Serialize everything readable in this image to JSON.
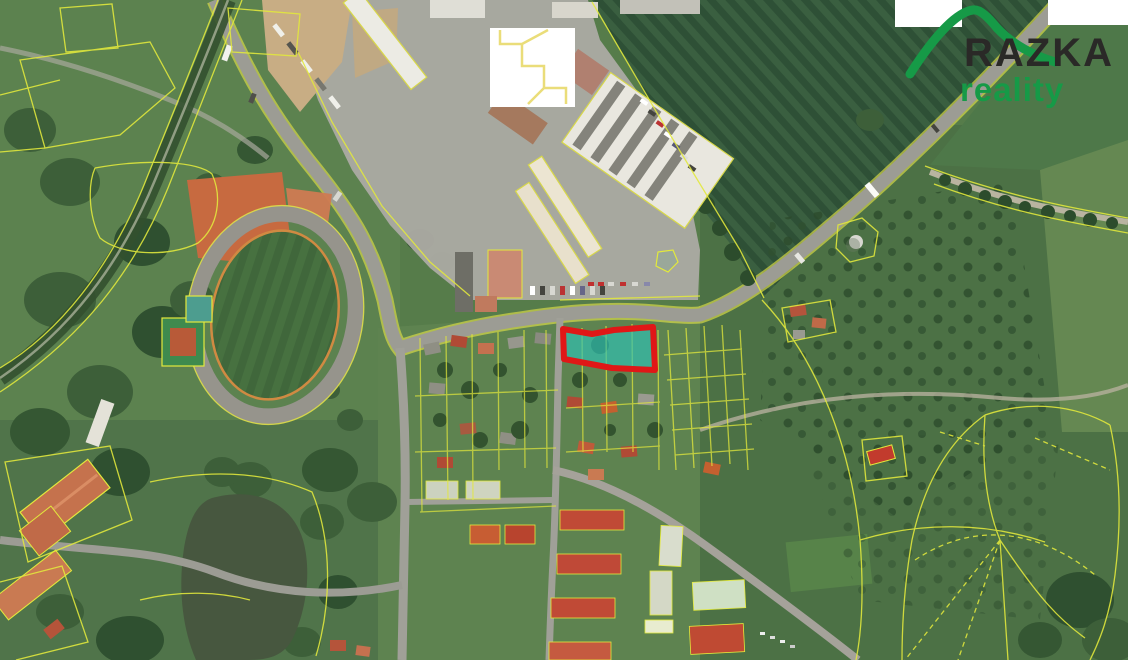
{
  "page": {
    "type": "aerial-cadastral-map-screenshot",
    "width": 1128,
    "height": 660
  },
  "logo": {
    "brand": "RAZKA",
    "subtitle": "reality",
    "brand_color": "#2a2927",
    "accent_color": "#169a47"
  },
  "map": {
    "cadastre_line_color": "#e3e93c",
    "highlighted_parcel": {
      "stroke": "#e01717",
      "fill": "#2ec2b6",
      "fill_opacity": "0.66",
      "stroke_width": "6"
    },
    "redaction_color": "#ffffff",
    "features": [
      "athletics-stadium",
      "clay-courts",
      "tennis-court",
      "sports-hall",
      "industrial-warehouses",
      "logistics-hall",
      "sand-yard",
      "striped-crop-field",
      "meadow-with-sapling-clumps",
      "tree-lined-lane",
      "pond",
      "manor-buildings",
      "residential-houses",
      "apartment-blocks",
      "school-buildings",
      "railway",
      "main-road",
      "water-tower",
      "planned-parcel-fan",
      "redaction-patches",
      "highlighted-parcel"
    ]
  }
}
